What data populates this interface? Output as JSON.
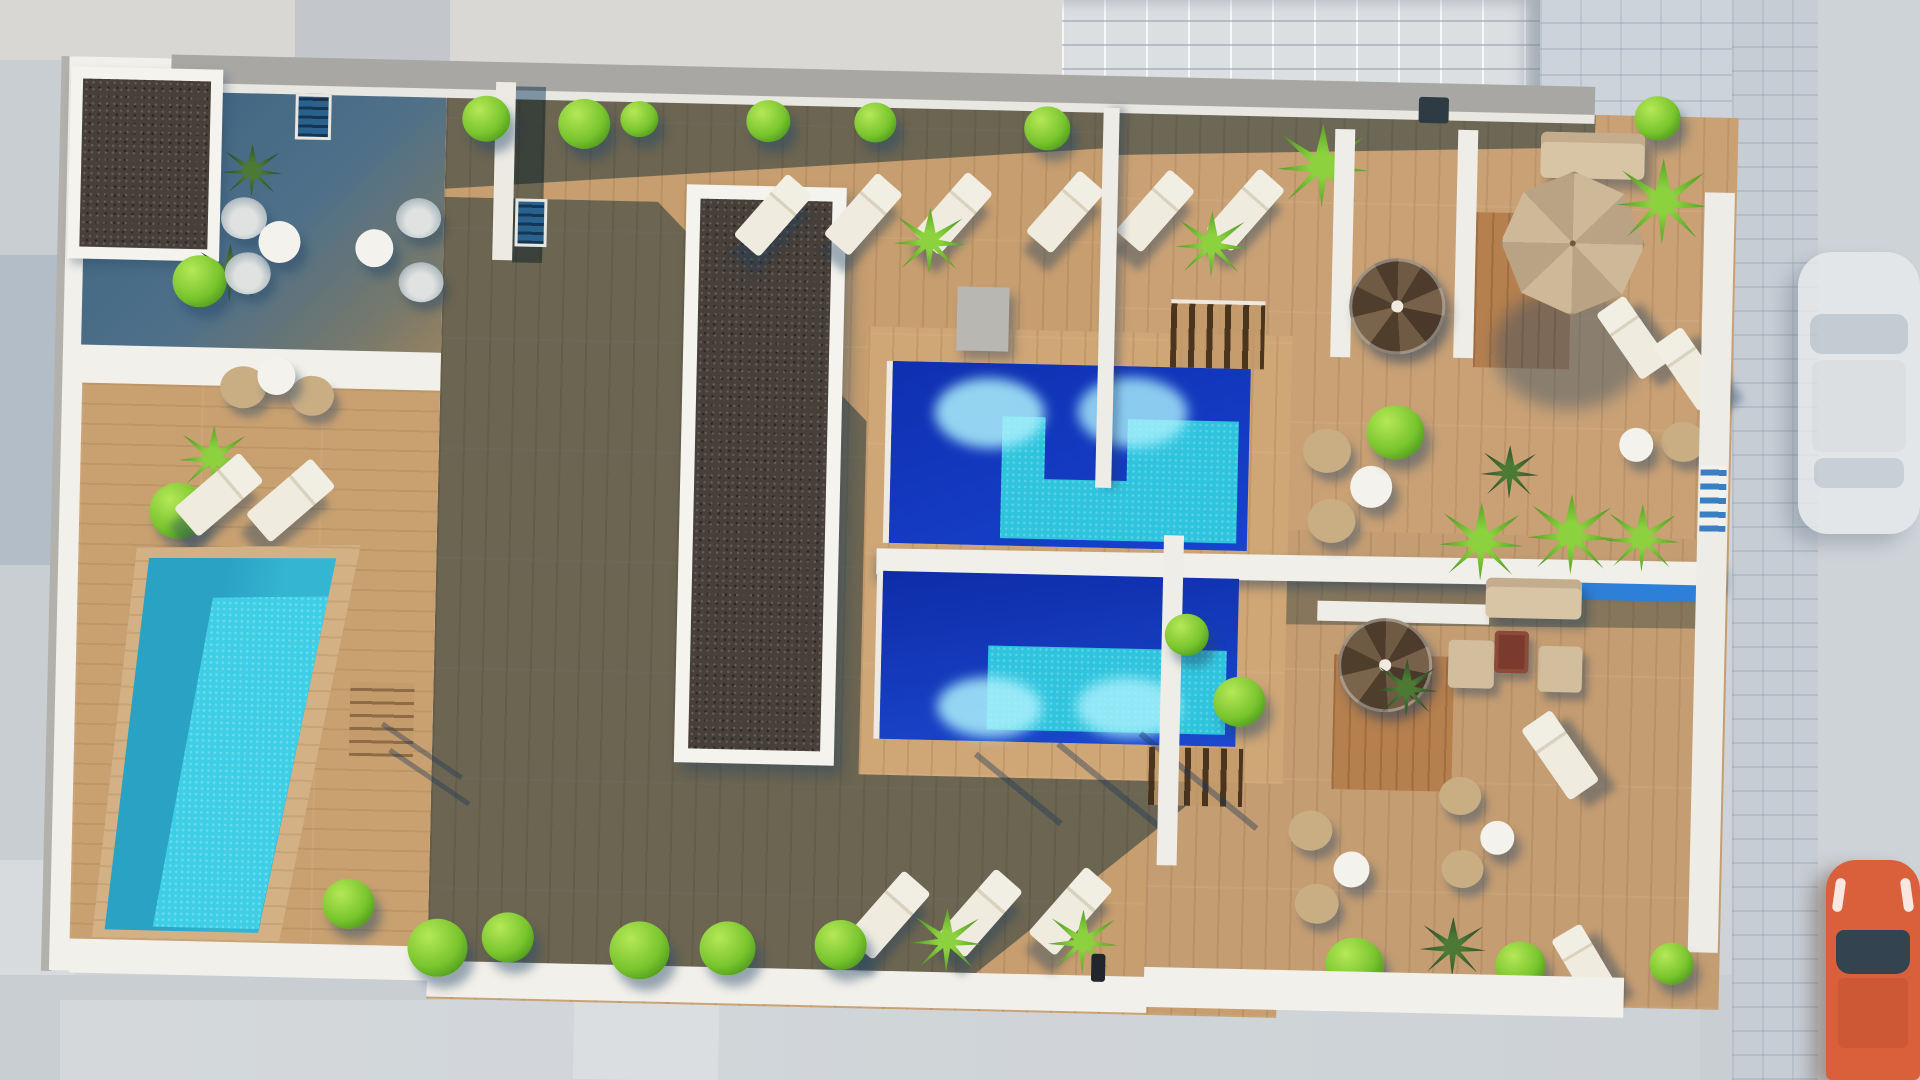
{
  "meta": {
    "kind": "architectural-3d-render",
    "view": "top-down aerial",
    "subject": "rooftop terrace of an apartment building with swimming pools, sun decks and street below",
    "visible_text": ""
  },
  "palette": {
    "street": "#cfd3d7",
    "street_light": "#dadde0",
    "street_blue": "#b2bdc8",
    "wall": "#f2f0ea",
    "wall_gray": "#a8a7a3",
    "deck": "#c79e6f",
    "deck_warm": "#cfa676",
    "shadow_teal": "#2a5880",
    "gravel": "#473f38",
    "pool_deep_blue": "#1238c4",
    "pool_turquoise": "#2fc4de",
    "pool_private_teal": "#2aa2c4",
    "pool_private_bright": "#3ecfe6",
    "greenery": "#79c52e",
    "parasol_tan": "#c9b49a",
    "car_orange": "#d9603b",
    "car_white": "#e8ebec"
  },
  "inventory": {
    "main_pools": 2,
    "private_pool": 1,
    "gravel_beds": 2,
    "sun_loungers": 15,
    "wicker_chairs": 12,
    "round_tables": 7,
    "parasol": 1,
    "spiral_staircases": 2,
    "straight_stairs": 3,
    "shrubs": 18,
    "palm_plants": 10,
    "lounge_sofa_sets": 2,
    "fire_table": 1,
    "cars": 2,
    "tiled_roof_building": 1
  }
}
